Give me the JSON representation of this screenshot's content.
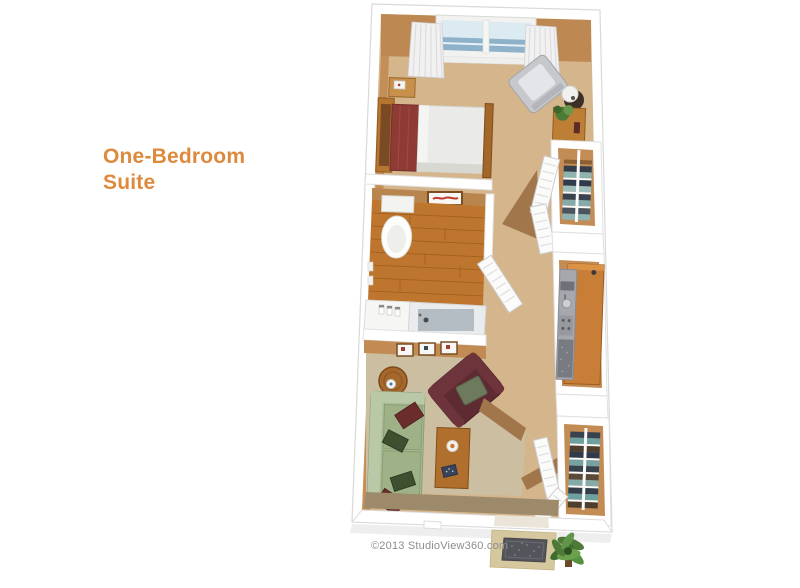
{
  "page": {
    "background": "#ffffff"
  },
  "title": {
    "text": "One-Bedroom Suite",
    "line1": "One-Bedroom",
    "line2": "Suite",
    "color": "#de8a3d"
  },
  "footer": {
    "copyright": "©2013 StudioView360.com",
    "color": "#8d8d8d"
  },
  "floorplan": {
    "type": "3d-rendered-floor-plan",
    "unit": "one-bedroom suite",
    "rooms": [
      {
        "name": "bedroom",
        "features": [
          "window-with-curtains",
          "bed",
          "nightstand-with-clock",
          "tall-dresser",
          "gray-armchair",
          "lamp-side-table",
          "plant-cabinet"
        ]
      },
      {
        "name": "bathroom",
        "features": [
          "toilet",
          "wall-picture",
          "wood-floor",
          "vanity-with-toiletries",
          "bathtub-shower"
        ]
      },
      {
        "name": "hallway",
        "features": [
          "linen-closet-with-towels",
          "louvered-bifold-doors",
          "louvered-bathroom-door"
        ]
      },
      {
        "name": "kitchenette",
        "features": [
          "wood-counter",
          "microwave",
          "sink",
          "cooktop",
          "refrigerator"
        ]
      },
      {
        "name": "living-room",
        "features": [
          "green-sofa-with-pillows",
          "maroon-armchair",
          "coffee-table",
          "round-side-table",
          "three-wall-pictures"
        ]
      },
      {
        "name": "entry",
        "features": [
          "wardrobe-closet-with-clothes",
          "louvered-closet-doors",
          "doormat",
          "potted-plant"
        ]
      }
    ],
    "colors": {
      "walls": "#ffffff",
      "carpet": "#d4b58c",
      "living_carpet": "#cbbea1",
      "wall_face": "#be8852",
      "wood_floor": "#be752d",
      "bed_blanket": "#8e3b35",
      "sofa": "#a9bb94",
      "armchair": "#5f2b33",
      "towel_teal": "#8fb3b0",
      "towel_navy": "#343e4a",
      "window_glass": "#8fb2cb",
      "plant_green": "#4e7a38",
      "doormat": "#54555b"
    }
  }
}
